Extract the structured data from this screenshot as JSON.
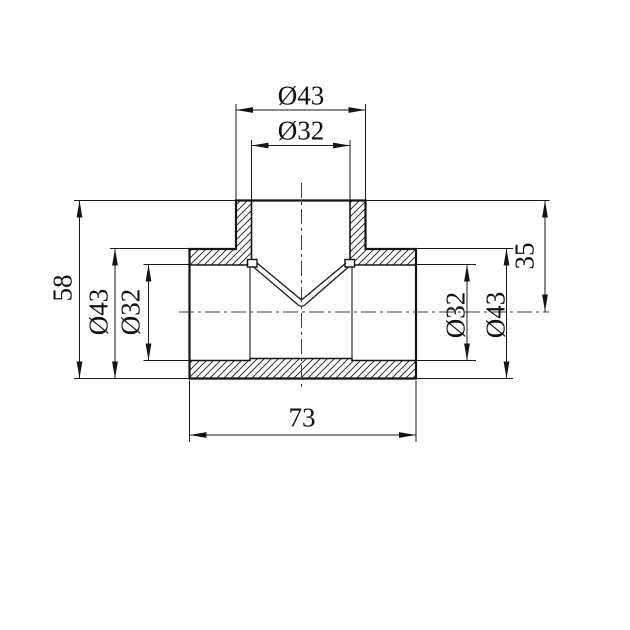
{
  "drawing": {
    "colors": {
      "line": "#141414",
      "background": "#ffffff",
      "centerline": "#3c3c3c"
    },
    "dimensions": {
      "top_outer_diameter": "Ø43",
      "top_inner_diameter": "Ø32",
      "overall_height": "58",
      "left_outer_diameter": "Ø43",
      "left_inner_diameter": "Ø32",
      "right_inner_diameter": "Ø32",
      "right_outer_diameter": "Ø43",
      "branch_center_height": "35",
      "overall_length": "73"
    }
  }
}
